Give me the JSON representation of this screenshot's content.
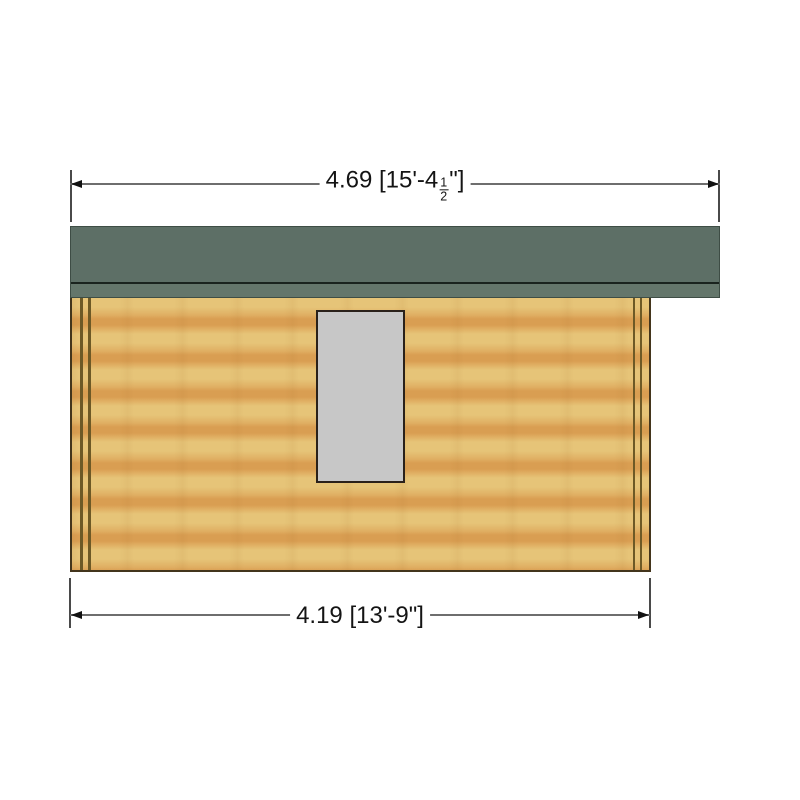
{
  "colors": {
    "page_bg": "#ffffff",
    "text": "#141414",
    "dim_line": "#6e6e6e",
    "ext_line": "#4a4a4a",
    "arrow": "#111111",
    "roof_green": "#5d6f66",
    "roof_fascia": "#64766b",
    "roof_line": "#1a231e",
    "roof_edge": "#3e4d45",
    "wood_light": "#e6c478",
    "wood_mid": "#e0af63",
    "wood_orange": "#d99e52",
    "trim_brown": "#6d5926",
    "wall_outline": "#43351c",
    "window_fill": "#c7c7c7",
    "window_border": "#2a211a"
  },
  "dimensions": {
    "top": {
      "metric": "4.69",
      "imperial": "15'-4 1/2\"",
      "text_before_fraction": "4.69 [15'-4",
      "fraction": {
        "numerator": "1",
        "denominator": "2"
      },
      "text_after_fraction": "\"]"
    },
    "bottom": {
      "metric": "4.19",
      "imperial": "13'-9\"",
      "text": "4.19 [13'-9\"]"
    }
  }
}
